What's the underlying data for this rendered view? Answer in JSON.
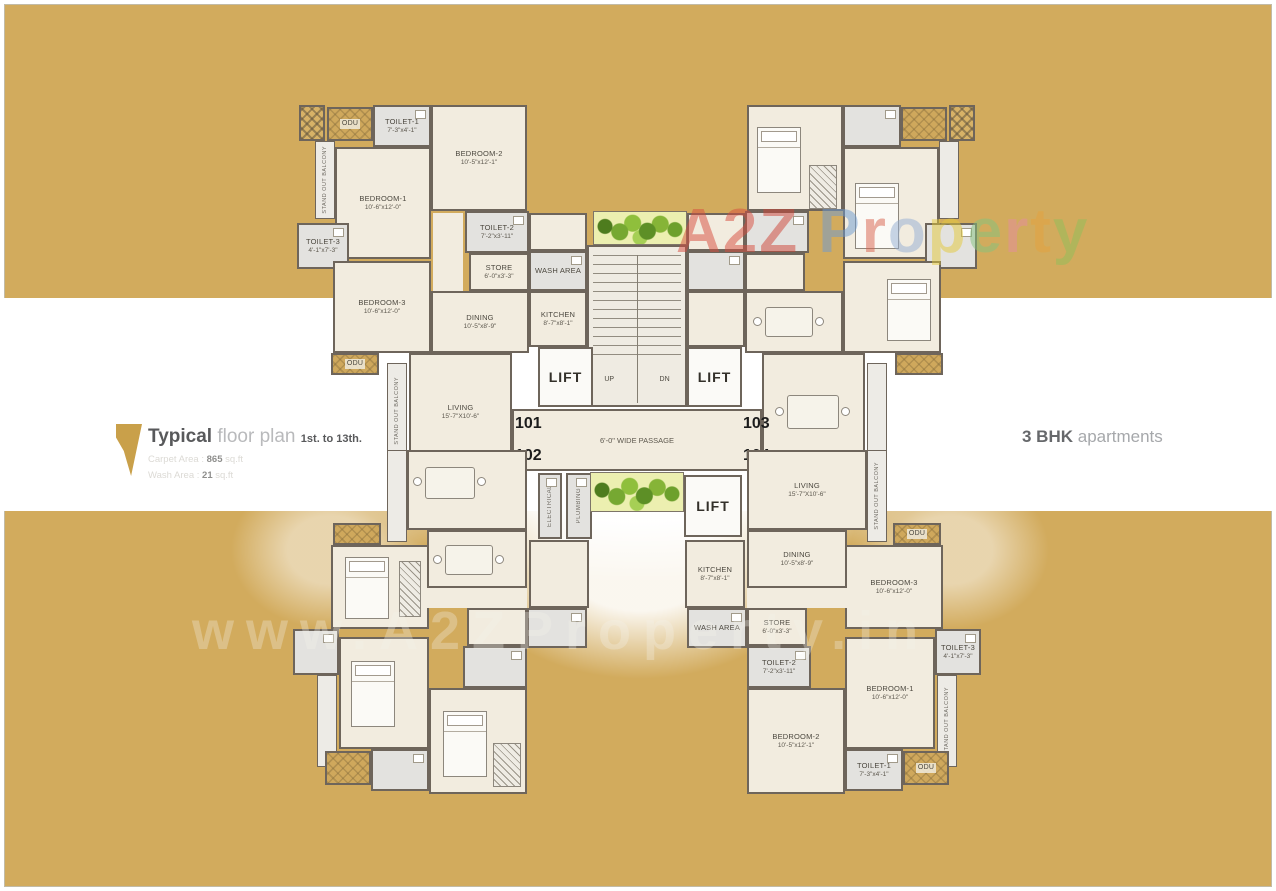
{
  "scene": {
    "background_color": "#d2ab5d",
    "band_color": "#ffffff",
    "wall_color": "#6e655b",
    "floor_color": "#f2ecdf"
  },
  "title_block": {
    "title_bold": "Typical",
    "title_light": " floor plan ",
    "title_range": "1st. to 13th.",
    "carpet_label": "Carpet Area : ",
    "carpet_value": "865",
    "carpet_unit": " sq.ft",
    "wash_label": "Wash Area : ",
    "wash_value": "21",
    "wash_unit": " sq.ft"
  },
  "caption_right": {
    "bold": "3 BHK",
    "light": " apartments"
  },
  "watermark": {
    "url_text": "www.A2ZProperty.in",
    "brand_letters": [
      {
        "ch": "A",
        "color": "#d84c3e"
      },
      {
        "ch": "2",
        "color": "#d84c3e"
      },
      {
        "ch": "Z",
        "color": "#cf4437"
      },
      {
        "ch": " ",
        "color": "#ffffff"
      },
      {
        "ch": "P",
        "color": "#6d9bd3"
      },
      {
        "ch": "r",
        "color": "#d9604b"
      },
      {
        "ch": "o",
        "color": "#93add4"
      },
      {
        "ch": "p",
        "color": "#e3c93a"
      },
      {
        "ch": "e",
        "color": "#84c47e"
      },
      {
        "ch": "r",
        "color": "#e58ea0"
      },
      {
        "ch": "t",
        "color": "#e5a33e"
      },
      {
        "ch": "y",
        "color": "#8fbf5a"
      }
    ]
  },
  "core": {
    "lift": "LIFT",
    "up": "UP",
    "dn": "DN",
    "passage": "6'-0\" WIDE PASSAGE",
    "electrical": "ELECTRICAL",
    "plumbing": "PLUMBING",
    "unit_101": "101",
    "unit_102": "102",
    "unit_103": "103",
    "unit_104": "104"
  },
  "room_labels": {
    "odu": "ODU",
    "balcony": "STAND OUT BALCONY",
    "toilet1": {
      "name": "TOILET-1",
      "dims": "7'-3\"x4'-1\""
    },
    "toilet2": {
      "name": "TOILET-2",
      "dims": "7'-2\"x3'-11\""
    },
    "toilet3": {
      "name": "TOILET-3",
      "dims": "4'-1\"x7'-3\""
    },
    "bedroom1": {
      "name": "BEDROOM-1",
      "dims": "10'-6\"x12'-0\""
    },
    "bedroom2": {
      "name": "BEDROOM-2",
      "dims": "10'-5\"x12'-1\""
    },
    "bedroom3": {
      "name": "BEDROOM-3",
      "dims": "10'-6\"x12'-0\""
    },
    "kitchen": {
      "name": "KITCHEN",
      "dims": "8'-7\"x8'-1\""
    },
    "dining": {
      "name": "DINING",
      "dims": "10'-5\"x8'-9\""
    },
    "living": {
      "name": "LIVING",
      "dims": "15'-7\"X10'-6\""
    },
    "store": {
      "name": "STORE",
      "dims": "6'-0\"x3'-3\""
    },
    "wash": {
      "name": "WASH AREA"
    }
  }
}
